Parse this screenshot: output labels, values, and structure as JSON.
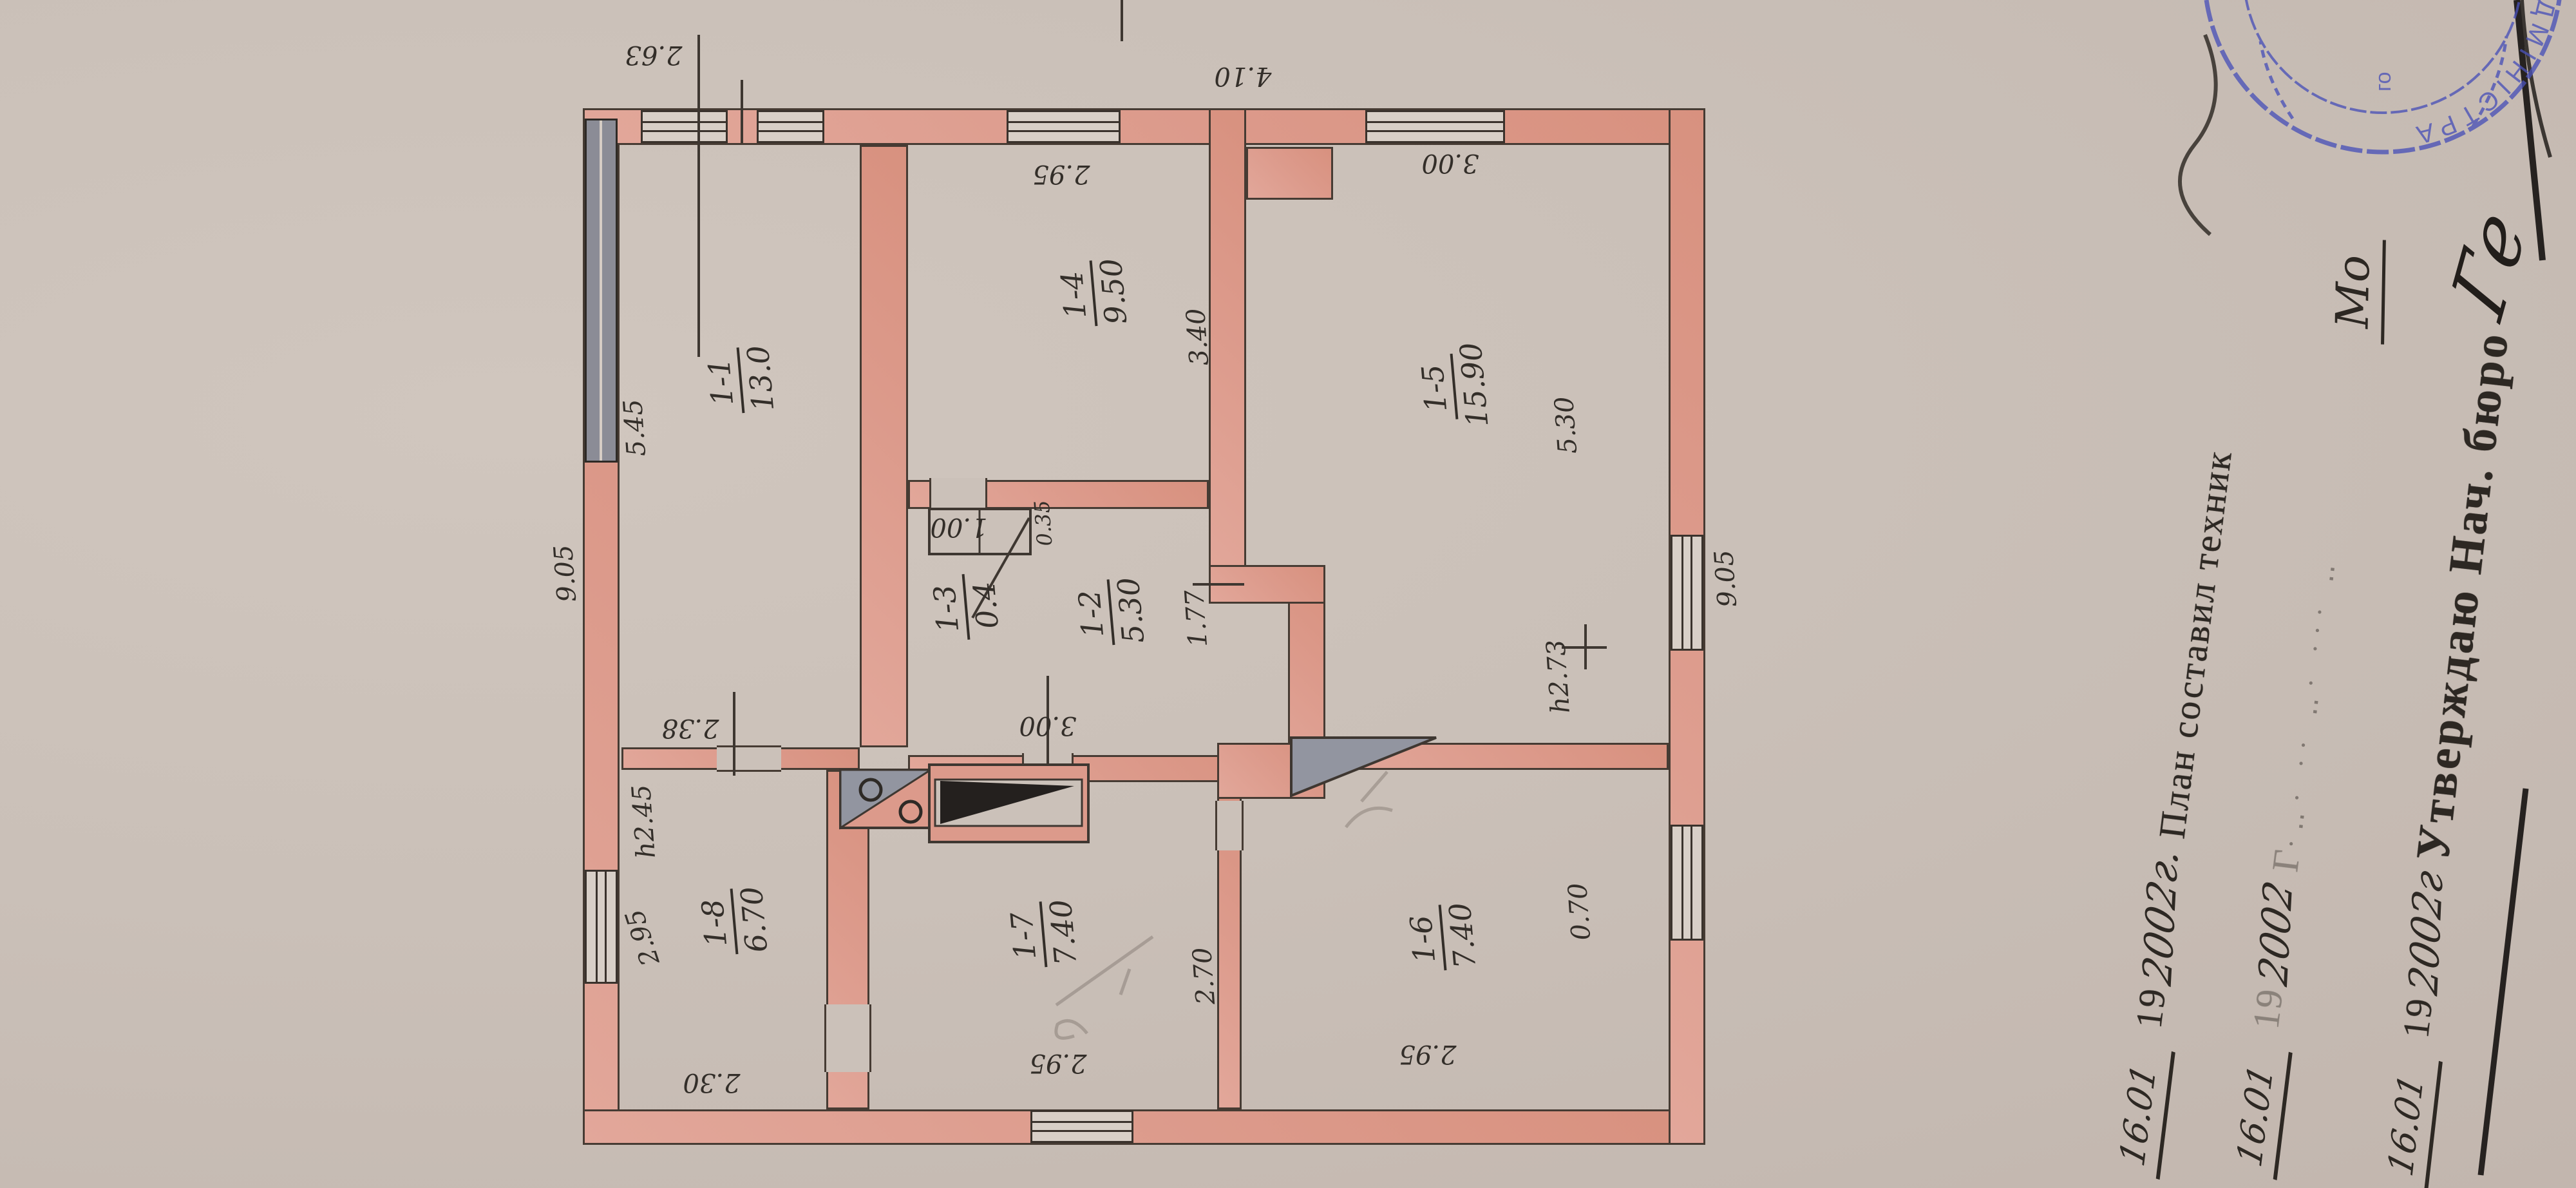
{
  "plan": {
    "rooms": [
      {
        "id": "1-1",
        "area": "13.0"
      },
      {
        "id": "1-2",
        "area": "5.30"
      },
      {
        "id": "1-3",
        "area": "0.4"
      },
      {
        "id": "1-4",
        "area": "9.50"
      },
      {
        "id": "1-5",
        "area": "15.90"
      },
      {
        "id": "1-6",
        "area": "7.40"
      },
      {
        "id": "1-7",
        "area": "7.40"
      },
      {
        "id": "1-8",
        "area": "6.70"
      }
    ],
    "dims": {
      "top_overall": "9.05",
      "bottom_overall": "9.05",
      "r11_width": "5.45",
      "r11_depth": "2.38",
      "win_2_63": "2.63",
      "win_14": "2.95",
      "seg_4_10": "4.10",
      "win_15": "3.00",
      "r15_width": "5.30",
      "r15_height": "h2.73",
      "win_16": "0.70",
      "r16_depth": "2.95",
      "r17_depth": "2.95",
      "r18_depth": "2.30",
      "win_18": "2.95",
      "r18_height": "h2.45",
      "closet_w": "1.00",
      "closet_d": "0.35",
      "door_12_17": "3.00",
      "seg_1_77": "1.77",
      "r14_width": "3.40",
      "r17_width": "2.70"
    }
  },
  "document": {
    "rows": [
      {
        "date": "16.01",
        "year_print": "19",
        "year_hand": "2002г.",
        "text": "План составил техник"
      },
      {
        "date": "16.01",
        "year_print": "19",
        "year_hand": "2002",
        "text": "Г",
        "end_hand": "Мо"
      },
      {
        "date": "16.01",
        "year_print": "19",
        "year_hand": "2002г",
        "text": "Утверждаю Нач. бюро",
        "signature": "Ге"
      }
    ]
  },
  "stamp": {
    "arc_text": "АДМІНІСТРА",
    "inner_text": "го",
    "color": "#4a52b8"
  },
  "colors": {
    "paper": "#cac0b8",
    "wall_pink": "#dc9a8b",
    "ink": "#3a322c",
    "glazing_gray": "#8b8c96",
    "stamp_blue": "#4a52b8"
  }
}
